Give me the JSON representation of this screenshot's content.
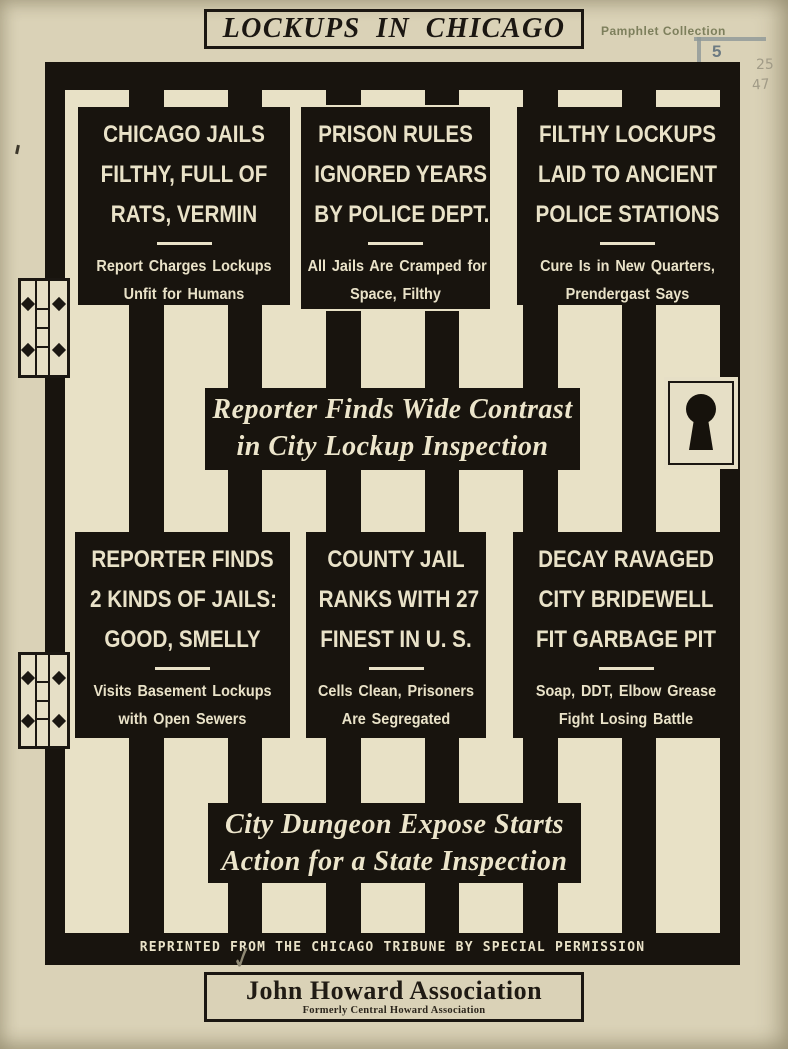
{
  "title_banner": {
    "text": "LOCKUPS IN CHICAGO"
  },
  "stamps": {
    "collection_label": "Pamphlet Collection",
    "shelf_number": "5",
    "pencil_note_1": "25",
    "pencil_note_2": "47",
    "checkmark": "✓"
  },
  "headline_boxes": [
    {
      "lines": [
        "CHICAGO JAILS",
        "FILTHY, FULL OF",
        "RATS, VERMIN"
      ],
      "sub": [
        "Report Charges Lockups",
        "Unfit for Humans"
      ]
    },
    {
      "lines": [
        "PRISON RULES",
        "IGNORED YEARS",
        "BY POLICE DEPT."
      ],
      "sub": [
        "All Jails Are Cramped for",
        "Space, Filthy"
      ]
    },
    {
      "lines": [
        "FILTHY LOCKUPS",
        "LAID TO ANCIENT",
        "POLICE STATIONS"
      ],
      "sub": [
        "Cure Is in New Quarters,",
        "Prendergast Says"
      ]
    },
    {
      "lines": [
        "REPORTER FINDS",
        "2 KINDS OF JAILS:",
        "GOOD, SMELLY"
      ],
      "sub": [
        "Visits Basement Lockups",
        "with Open Sewers"
      ]
    },
    {
      "lines": [
        "COUNTY JAIL",
        "RANKS WITH 27",
        "FINEST IN U. S."
      ],
      "sub": [
        "Cells Clean, Prisoners",
        "Are Segregated"
      ]
    },
    {
      "lines": [
        "DECAY RAVAGED",
        "CITY BRIDEWELL",
        "FIT GARBAGE PIT"
      ],
      "sub": [
        "Soap, DDT, Elbow Grease",
        "Fight Losing Battle"
      ]
    }
  ],
  "banners": [
    {
      "line1": "Reporter Finds Wide Contrast",
      "line2": "in City Lockup Inspection"
    },
    {
      "line1": "City Dungeon Expose Starts",
      "line2": "Action for a State Inspection"
    }
  ],
  "footer": {
    "reprint_notice": "REPRINTED FROM THE CHICAGO TRIBUNE BY SPECIAL PERMISSION"
  },
  "publisher_box": {
    "name": "John Howard Association",
    "subtitle": "Formerly Central Howard Association"
  },
  "colors": {
    "paper": "#dad2b7",
    "ink_black": "#18140e",
    "cream_text": "#e9e2c8",
    "stamp_olive": "#7d7f5c",
    "stamp_gray": "#8d9797",
    "pencil_gray": "#a19b87"
  }
}
